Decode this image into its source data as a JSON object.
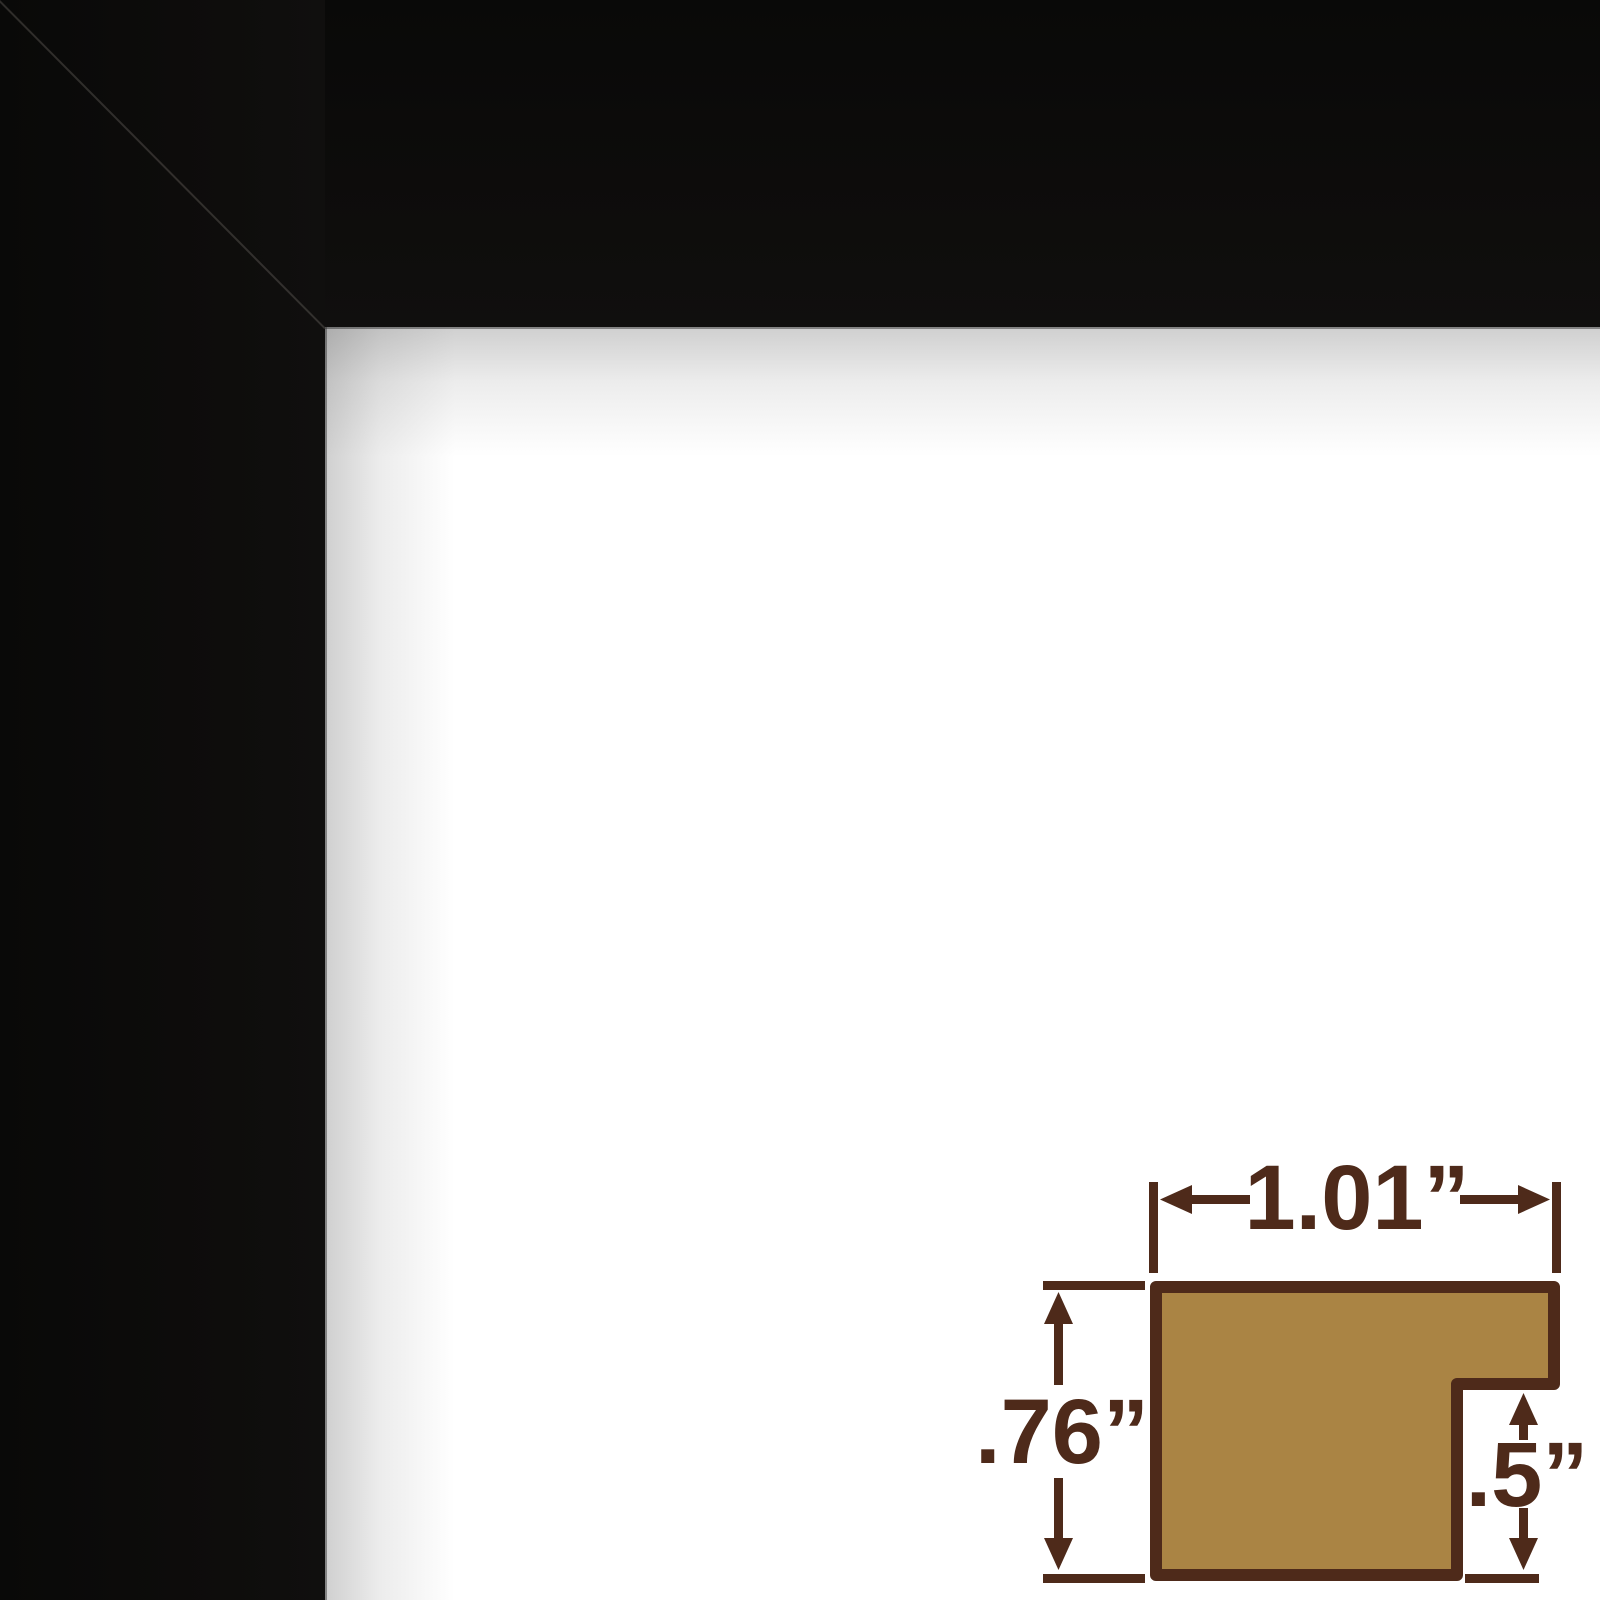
{
  "frame_sample": {
    "description": "black picture frame corner with white mat",
    "frame_color": "#0d0c0b",
    "mat_color": "#ffffff"
  },
  "profile_diagram": {
    "width_label": "1.01”",
    "height_label": ".76”",
    "rabbet_label": ".5”",
    "line_color": "#4e2a1a",
    "wood_fill_color": "#aa8444"
  }
}
